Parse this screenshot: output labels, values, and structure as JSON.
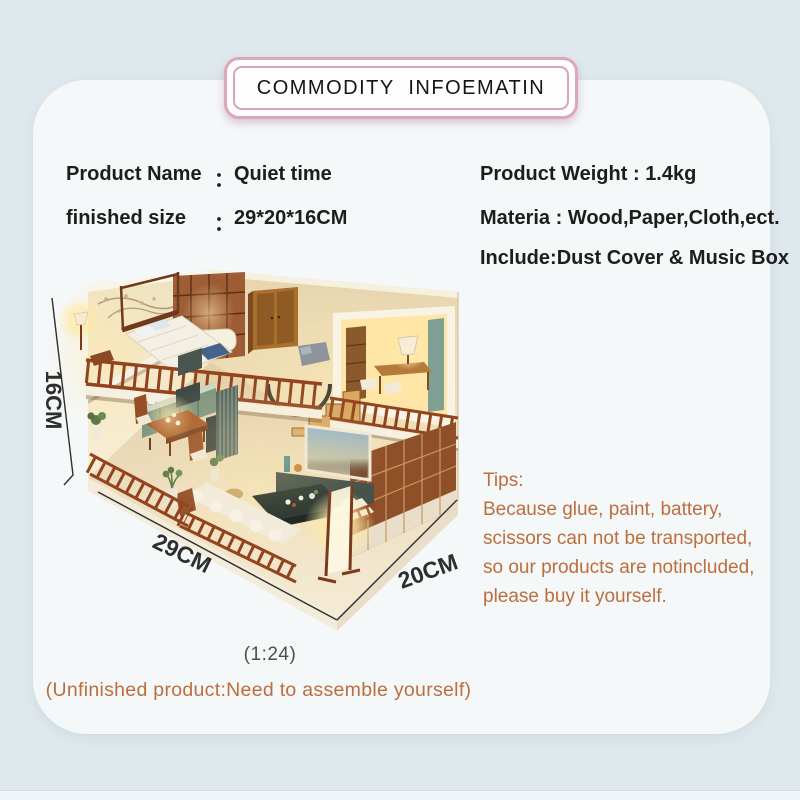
{
  "page": {
    "background_color": "#dfe9ed",
    "card_color": "#f5f8f9",
    "accent_pink": "#dca7bc",
    "accent_orange": "#bd6e3d"
  },
  "header": {
    "title": "COMMODITY INFOEMATIN"
  },
  "product_info": {
    "left": [
      {
        "label": "Product Name",
        "colon": "：",
        "value": "Quiet time"
      },
      {
        "label": "finished size",
        "colon": "：",
        "value": "29*20*16CM"
      }
    ],
    "right": [
      {
        "label": "Product Weight",
        "colon": " : ",
        "value": "1.4kg"
      },
      {
        "label": "Materia",
        "colon": " : ",
        "value": "Wood,Paper,Cloth,ect."
      },
      {
        "label": "Include",
        "colon": ":",
        "value": "Dust Cover & Music Box"
      }
    ]
  },
  "photo": {
    "description": "Two-story Chinese style DIY miniature dollhouse with warm lights",
    "dimension_height": "16CM",
    "dimension_length": "29CM",
    "dimension_depth": "20CM"
  },
  "tips": {
    "heading": "Tips:",
    "lines": [
      "Because glue, paint, battery,",
      "scissors can not be transported,",
      "so our products are notincluded,",
      "please buy it yourself."
    ]
  },
  "notes": {
    "scale": "(1:24)",
    "assembly": "(Unfinished product:Need to assemble yourself)"
  }
}
